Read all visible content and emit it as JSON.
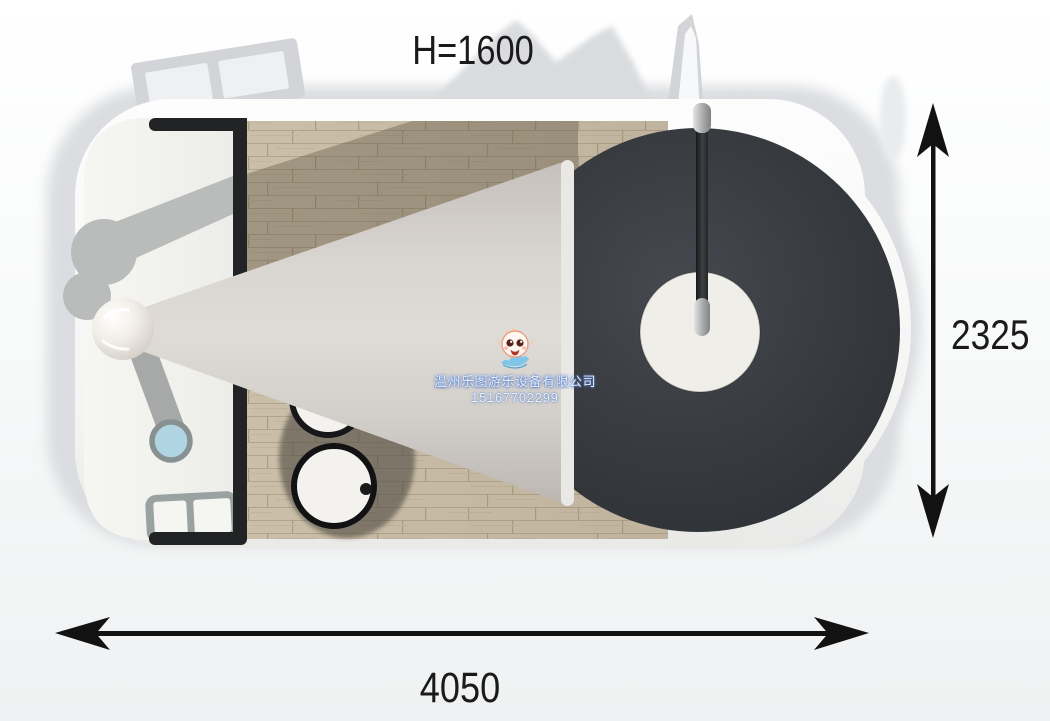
{
  "diagram": {
    "height_label": "H=1600",
    "width_value": "4050",
    "depth_value": "2325"
  },
  "watermark": {
    "company": "温州乐图游乐设备有限公司",
    "phone": "15167702299"
  },
  "colors": {
    "annotation_ink": "#1a1a1a",
    "dark_platform": "#383b40",
    "wood_floor": "#c9bda8",
    "cone_slide": "#d6d1cc",
    "blue_seat": "#aed5e1",
    "stool_fill": "#f3f2ee",
    "wall_edge": "#212325",
    "watermark_text": "#e9effb"
  }
}
